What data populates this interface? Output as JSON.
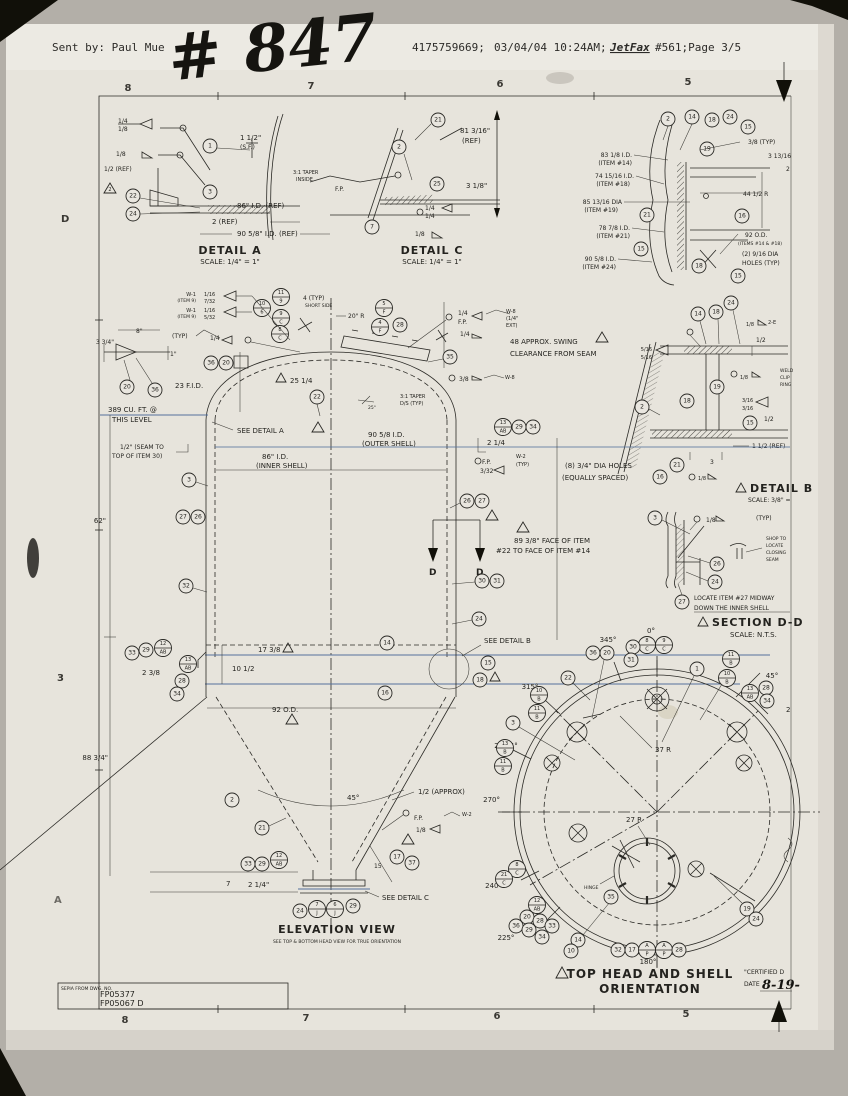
{
  "fax_header": {
    "sent_by": "Sent by: Paul Mue",
    "handwritten": "# 847",
    "fax_number": "4175759669;",
    "datetime": "03/04/04 10:24AM;",
    "jetfax": "JetFax",
    "page_info": "#561;Page 3/5"
  },
  "border": {
    "top": [
      "8",
      "7",
      "6",
      "5"
    ],
    "bottom": [
      "8",
      "7",
      "6",
      "5"
    ],
    "left": [
      "D",
      "3",
      "A"
    ]
  },
  "title_block": {
    "label": "SEPIA FROM DWG. NO.",
    "dwg_no_1": "FP05377",
    "dwg_no_2": "FP05067 D"
  },
  "certified": {
    "line1": "\"CERTIFIED D",
    "line2": "DATE",
    "date": "8-19-"
  },
  "detail_a": {
    "title": "DETAIL A",
    "scale": "SCALE: 1/4\" = 1\"",
    "weld_top": "1/4",
    "weld_top2": "1/8",
    "weld_mid": "1/8",
    "ref_half": "1/2 (REF)",
    "rev": "2",
    "balloons": [
      "1",
      "3",
      "22",
      "24"
    ],
    "dim_sf": "1 1/2\"",
    "dim_sf2": "(S.F.)",
    "dim_id86": "86\" I.D. (REF)",
    "dim_2ref": "2 (REF)",
    "dim_id90": "90 5/8\" I.D. (REF)"
  },
  "detail_c": {
    "title": "DETAIL C",
    "scale": "SCALE: 1/4\" = 1\"",
    "balloons": [
      "21",
      "2",
      "25",
      "7"
    ],
    "dim_ref": "81 3/16\"",
    "dim_ref2": "(REF)",
    "dim_318": "3 1/8\"",
    "taper": "3:1 TAPER",
    "taper2": "INSIDE",
    "fp": "F.P.",
    "weld1": "1/4",
    "weld2": "1/4",
    "weld3": "1/8"
  },
  "head_detail": {
    "balloons": [
      "2",
      "14",
      "18",
      "24",
      "15",
      "19",
      "21",
      "16",
      "15",
      "18",
      "15"
    ],
    "left_labels": [
      [
        "83 1/8 I.D.",
        "(ITEM #14)"
      ],
      [
        "74 15/16 I.D.",
        "(ITEM #18)"
      ],
      [
        "85 13/16 DIA",
        "(ITEM #19)"
      ],
      [
        "78 7/8 I.D.",
        "(ITEM #21)"
      ],
      [
        "90 5/8 I.D.",
        "(ITEM #24)"
      ]
    ],
    "right_labels": {
      "typ": "3/8 (TYP)",
      "d313": "3 13/16",
      "d2": "2",
      "r44": "44 1/2 R",
      "od": "92 O.D.",
      "od2": "(ITEMS #14 & #18)",
      "holes": "(2) 9/16 DIA",
      "holes2": "HOLES (TYP)"
    }
  },
  "detail_b": {
    "title": "DETAIL B",
    "scale": "SCALE: 3/8\" =",
    "balloons": [
      "14",
      "18",
      "24",
      "2",
      "18",
      "19",
      "15",
      "21",
      "16"
    ],
    "w516a": "5/16",
    "w516b": "5/16",
    "w18a": "1/8",
    "w2e": "2-E",
    "half": "1/2",
    "w18b": "1/8",
    "clip": [
      "WELD",
      "CLIP",
      "RING"
    ],
    "w316a": "3/16",
    "w316b": "3/16",
    "half2": "1/2",
    "ref15": "1 1/2 (REF)",
    "d3": "3",
    "w18c": "1/8"
  },
  "section_dd": {
    "title": "SECTION D-D",
    "scale": "SCALE: N.T.S.",
    "balloons": [
      "3",
      "26",
      "24",
      "27"
    ],
    "w18": "1/8",
    "typ": "(TYP)",
    "shop": [
      "SHOP TO",
      "LOCATE",
      "CLOSING",
      "SEAM"
    ],
    "note1": "LOCATE ITEM #27 MIDWAY",
    "note2": "DOWN THE INNER SHELL"
  },
  "elevation": {
    "title": "ELEVATION VIEW",
    "subtitle": "SEE TOP & BOTTOM HEAD VIEW FOR TRUE ORIENTATION",
    "w1a": "W-1",
    "w1a2": "(ITEM 9)",
    "w1af": "1/16",
    "w1af2": "7/32",
    "w1b": "W-1",
    "w1b2": "(ITEM 9)",
    "w1bf": "1/16",
    "w1bf2": "5/32",
    "typ": "(TYP)",
    "typ_val": "1/4",
    "d4typ": "4 (TYP)",
    "short_side": "SHORT SIDE",
    "r20": "20\" R",
    "d8": "8\"",
    "d334": "3 3/4\"",
    "d1": "1\"",
    "fid": "23  F.I.D.",
    "cuft": "389 CU. FT. @",
    "cuft2": "THIS LEVEL",
    "seam": "1/2\" (SEAM TO",
    "seam2": "TOP OF ITEM 30)",
    "see_a": "SEE DETAIL A",
    "d2514": "25 1/4",
    "taper31": "3:1 TAPER",
    "taper31b": "D/S (TYP)",
    "deg25": "25°",
    "swing": "48  APPROX. SWING",
    "swing2": "CLEARANCE FROM SEAM",
    "w14": "1/4",
    "wfp": "F.P.",
    "w14b": "1/4",
    "w8": "W-8",
    "w8b": "(1/4\"",
    "w8c": "EXT)",
    "w38": "3/8",
    "w8r": "W-8",
    "id90": "90 5/8 I.D.",
    "id90b": "(OUTER SHELL)",
    "id86": "86\" I.D.",
    "id86b": "(INNER SHELL)",
    "d62": "62\"",
    "d8834": "88 3/4\"",
    "d214": "2 1/4",
    "fp2": "F.P.",
    "w332": "3/32",
    "w2": "W-2",
    "w2typ": "(TYP)",
    "holes8": "(8) 3/4\" DIA HOLES",
    "holes8b": "(EQUALLY SPACED)",
    "face89": "89 3/8\" FACE OF ITEM",
    "face89b": "#22 TO FACE OF ITEM #14",
    "dd": "D",
    "d1738": "17 3/8",
    "d1012": "10 1/2",
    "d238": "2 3/8",
    "od92": "92 O.D.",
    "see_b": "SEE DETAIL B",
    "see_c": "SEE DETAIL C",
    "deg45": "45°",
    "approx": "1/2 (APPROX)",
    "fp3": "F.P.",
    "w18": "1/8",
    "w2b": "W-2",
    "d15": "15",
    "d7": "7",
    "d214b": "2 1/4\"",
    "balloons": {
      "b1": "1",
      "b2": "2",
      "b3": "3",
      "b14": "14",
      "b15": "15",
      "b16": "16",
      "b17": "17",
      "b18": "18",
      "b20": "20",
      "b21": "21",
      "b22": "22",
      "b24": "24",
      "b26": "26",
      "b27": "27",
      "b28": "28",
      "b29": "29",
      "b30": "30",
      "b31": "31",
      "b32": "32",
      "b33": "33",
      "b34": "34",
      "b35": "35",
      "b36": "36",
      "b37": "37"
    },
    "stacks": {
      "s119": {
        "top": "11",
        "bot": "9"
      },
      "s106": {
        "top": "10",
        "bot": "6"
      },
      "s9c": {
        "top": "9",
        "bot": "C"
      },
      "s8c": {
        "top": "8",
        "bot": "C"
      },
      "s5f": {
        "top": "5",
        "bot": "F"
      },
      "s4f": {
        "top": "4",
        "bot": "F"
      },
      "s13ab": {
        "top": "13",
        "bot": "AB"
      },
      "s12ab": {
        "top": "12",
        "bot": "AB"
      },
      "s7j": {
        "top": "7",
        "bot": "J"
      },
      "s6j": {
        "top": "6",
        "bot": "J"
      }
    }
  },
  "orientation": {
    "title": "TOP HEAD AND SHELL",
    "title2": "ORIENTATION",
    "a0": "0°",
    "a345": "345°",
    "a315": "315°",
    "a2925": "292.5°",
    "a270": "270°",
    "a240": "240°",
    "a225": "225°",
    "a180": "180°",
    "a45": "45°",
    "r37": "37 R",
    "r27": "27 R",
    "hinge": "HINGE",
    "stray2": "2",
    "balloons": {
      "b1": "1",
      "b3": "3",
      "b10": "10",
      "b14": "14",
      "b17": "17",
      "b19": "19",
      "b20": "20",
      "b22": "22",
      "b24": "24",
      "b28": "28",
      "b29": "29",
      "b30": "30",
      "b31": "31",
      "b32": "32",
      "b33": "33",
      "b34": "34",
      "b35": "35",
      "b36": "36"
    },
    "stacks": {
      "o8c": {
        "top": "8",
        "bot": "C"
      },
      "o9c": {
        "top": "9",
        "bot": "C"
      },
      "o11b": {
        "top": "11",
        "bot": "B"
      },
      "o10b": {
        "top": "10",
        "bot": "B"
      },
      "o13ab": {
        "top": "13",
        "bot": "AB"
      },
      "o12ab": {
        "top": "12",
        "bot": "AB"
      },
      "o13b": {
        "top": "13",
        "bot": "B"
      },
      "o21c": {
        "top": "21",
        "bot": "C"
      },
      "oap": {
        "top": "A",
        "bot": "P"
      }
    }
  }
}
